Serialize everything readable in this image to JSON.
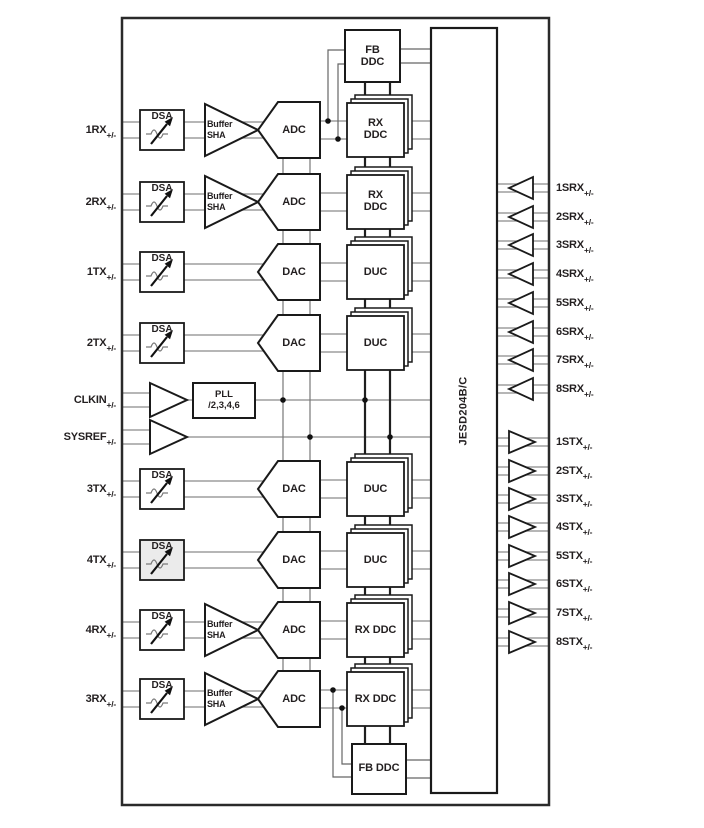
{
  "blocks": {
    "dsa": "DSA",
    "buffer1": "Buffer",
    "buffer2": "SHA",
    "adc": "ADC",
    "dac": "DAC",
    "duc": "DUC",
    "rx1": "RX",
    "ddc": "DDC",
    "fb1": "FB",
    "rx_ddc": "RX DDC",
    "fb_ddc": "FB DDC",
    "pll1": "PLL",
    "pll2": "/2,3,4,6",
    "jesd": "JESD204B/C"
  },
  "left_ports": [
    {
      "name": "1RX",
      "sub": "+/-"
    },
    {
      "name": "2RX",
      "sub": "+/-"
    },
    {
      "name": "1TX",
      "sub": "+/-"
    },
    {
      "name": "2TX",
      "sub": "+/-"
    },
    {
      "name": "CLKIN",
      "sub": "+/-"
    },
    {
      "name": "SYSREF",
      "sub": "+/-"
    },
    {
      "name": "3TX",
      "sub": "+/-"
    },
    {
      "name": "4TX",
      "sub": "+/-"
    },
    {
      "name": "4RX",
      "sub": "+/-"
    },
    {
      "name": "3RX",
      "sub": "+/-"
    }
  ],
  "srx_ports": [
    {
      "name": "1SRX",
      "sub": "+/-"
    },
    {
      "name": "2SRX",
      "sub": "+/-"
    },
    {
      "name": "3SRX",
      "sub": "+/-"
    },
    {
      "name": "4SRX",
      "sub": "+/-"
    },
    {
      "name": "5SRX",
      "sub": "+/-"
    },
    {
      "name": "6SRX",
      "sub": "+/-"
    },
    {
      "name": "7SRX",
      "sub": "+/-"
    },
    {
      "name": "8SRX",
      "sub": "+/-"
    }
  ],
  "stx_ports": [
    {
      "name": "1STX",
      "sub": "+/-"
    },
    {
      "name": "2STX",
      "sub": "+/-"
    },
    {
      "name": "3STX",
      "sub": "+/-"
    },
    {
      "name": "4STX",
      "sub": "+/-"
    },
    {
      "name": "5STX",
      "sub": "+/-"
    },
    {
      "name": "6STX",
      "sub": "+/-"
    },
    {
      "name": "7STX",
      "sub": "+/-"
    },
    {
      "name": "8STX",
      "sub": "+/-"
    }
  ],
  "colors": {
    "line": "#8a8a8a",
    "block_stroke": "#1a1a1a",
    "shaded_dsa_fill": "#ebebeb",
    "text": "#231f20"
  }
}
